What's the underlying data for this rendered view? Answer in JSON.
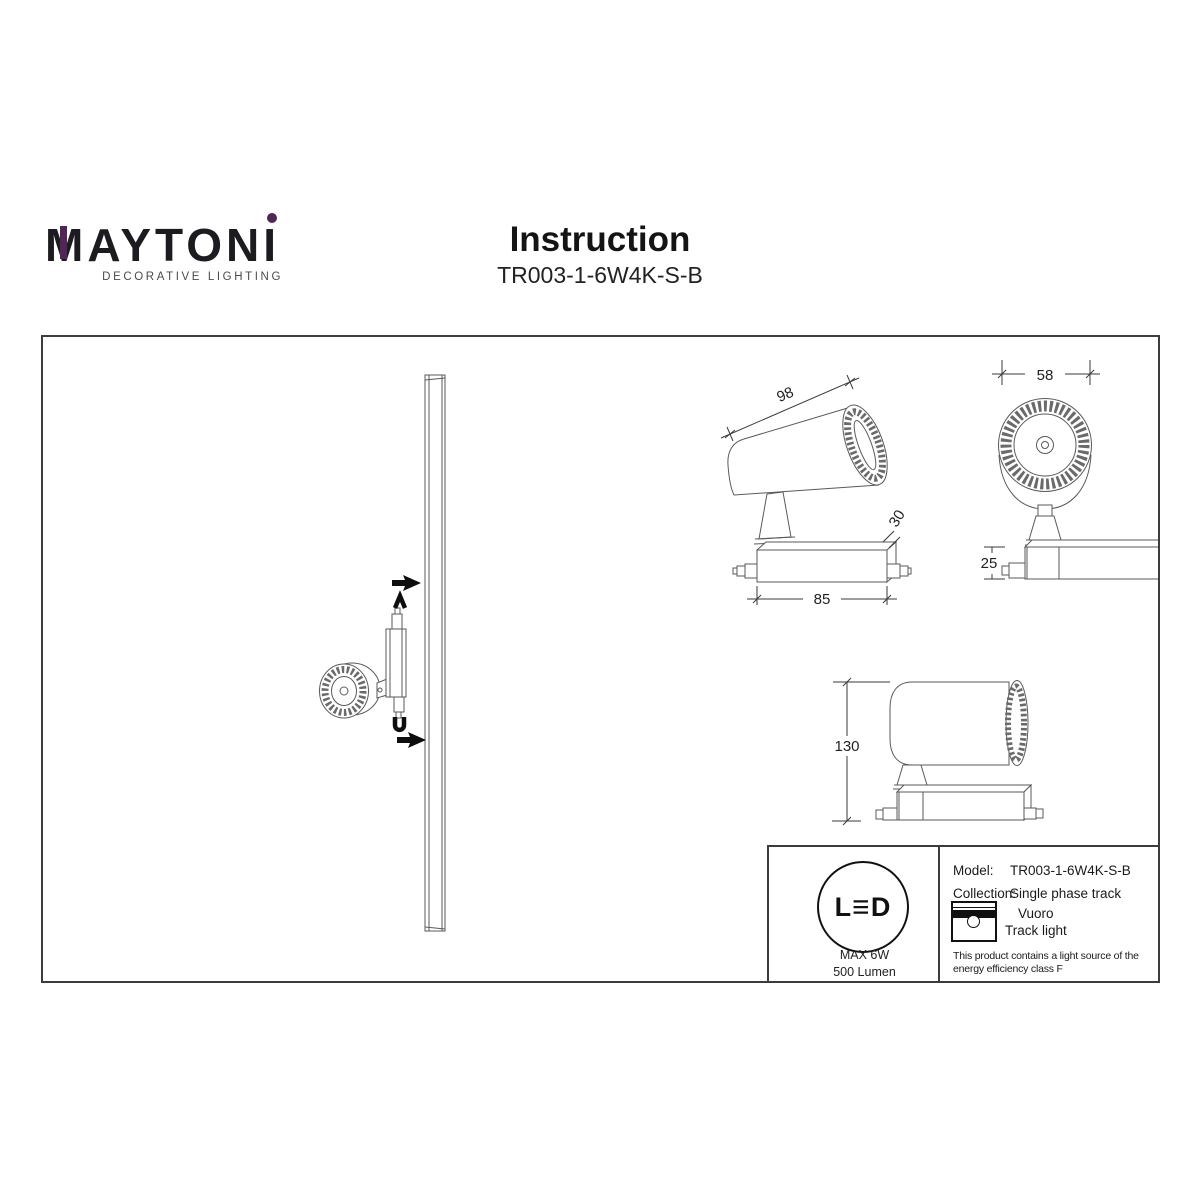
{
  "logo": {
    "text": "MAYTONI",
    "tagline": "DECORATIVE LIGHTING"
  },
  "header": {
    "title": "Instruction",
    "model": "TR003-1-6W4K-S-B"
  },
  "dims": {
    "side_perspective": {
      "length": "98",
      "base_depth": "30",
      "base_width": "85"
    },
    "front_view": {
      "head_width": "58",
      "base_height": "25"
    },
    "side_view": {
      "overall_height": "130"
    }
  },
  "info_panel": {
    "led_badge": {
      "letters": [
        "L",
        "≡",
        "D"
      ],
      "max_power": "MAX 6W",
      "luminous_flux": "500 Lumen"
    },
    "model_label": "Model:",
    "model_value": "TR003-1-6W4K-S-B",
    "collection_label": "Collection:",
    "collection_value": "Single phase track",
    "series_name": "Vuoro",
    "product_type": "Track light",
    "energy_note_line1": "This product contains a light source of the",
    "energy_note_line2": "energy efficiency class F"
  },
  "colors": {
    "accent_purple": "#522557",
    "line_gray": "#5a5a5a"
  }
}
